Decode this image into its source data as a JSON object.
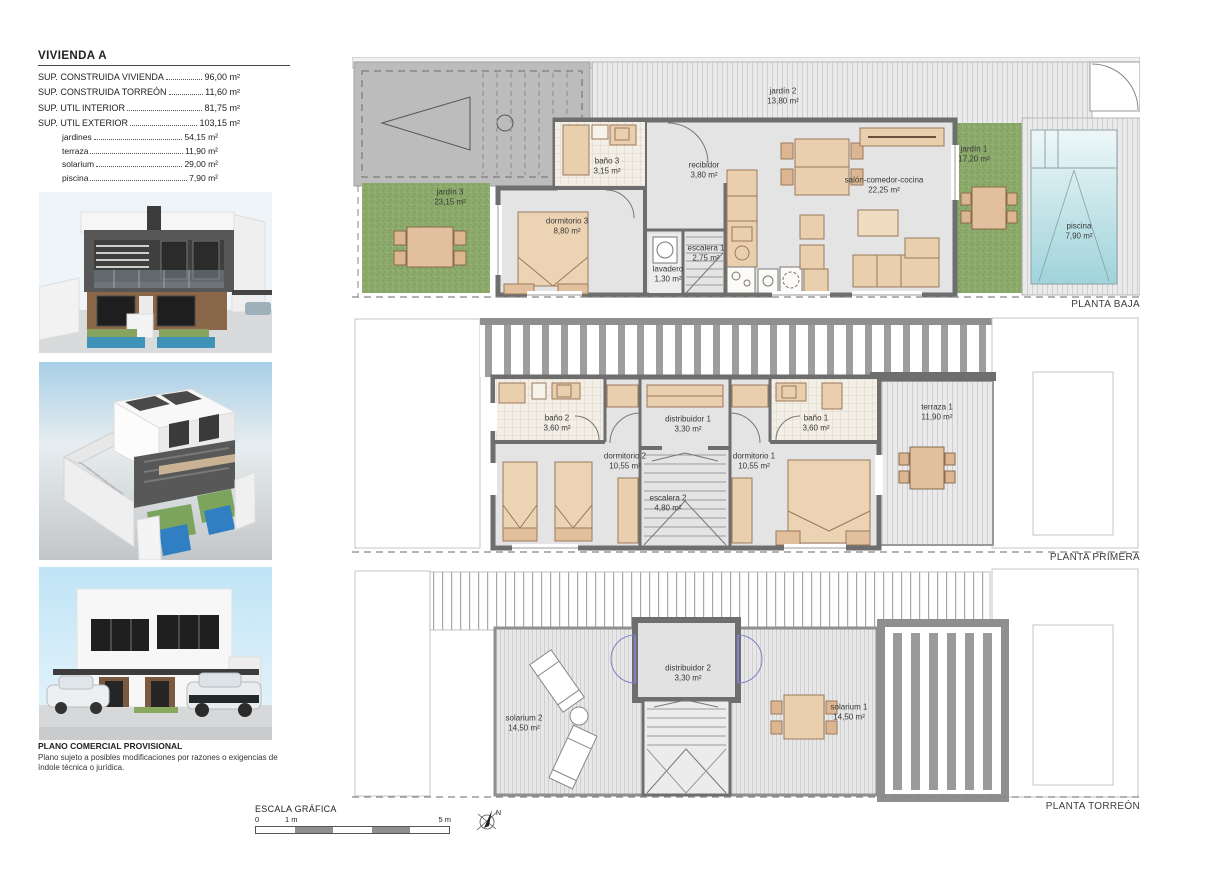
{
  "title_block": {
    "title": "VIVIENDA A",
    "rows": [
      {
        "label": "SUP. CONSTRUIDA VIVIENDA",
        "value": "96,00 m²"
      },
      {
        "label": "SUP. CONSTRUIDA TORREÓN",
        "value": "11,60 m²"
      },
      {
        "label": "SUP. UTIL INTERIOR",
        "value": "81,75 m²"
      },
      {
        "label": "SUP. UTIL EXTERIOR",
        "value": "103,15 m²"
      }
    ],
    "sub_rows": [
      {
        "label": "jardines",
        "value": "54,15 m²"
      },
      {
        "label": "terraza",
        "value": "11,90 m²"
      },
      {
        "label": "solarium",
        "value": "29,00 m²"
      },
      {
        "label": "piscina",
        "value": "7,90 m²"
      }
    ]
  },
  "plans": {
    "baja": {
      "name": "PLANTA BAJA",
      "rooms": {
        "jardin3": {
          "name": "jardín 3",
          "area": "23,15 m²"
        },
        "jardin2": {
          "name": "jardín 2",
          "area": "13,80 m²"
        },
        "jardin1": {
          "name": "jardín 1",
          "area": "17,20 m²"
        },
        "dormitorio3": {
          "name": "dormitorio 3",
          "area": "8,80 m²"
        },
        "bano3": {
          "name": "baño 3",
          "area": "3,15 m²"
        },
        "recibidor": {
          "name": "recibidor",
          "area": "3,80 m²"
        },
        "lavadero": {
          "name": "lavadero",
          "area": "1,30 m²"
        },
        "escalera1": {
          "name": "escalera 1",
          "area": "2,75 m²"
        },
        "salon": {
          "name": "salón-comedor-cocina",
          "area": "22,25 m²"
        },
        "piscina": {
          "name": "piscina",
          "area": "7,90 m²"
        }
      }
    },
    "primera": {
      "name": "PLANTA PRIMERA",
      "rooms": {
        "bano2": {
          "name": "baño 2",
          "area": "3,60 m²"
        },
        "dormitorio2": {
          "name": "dormitorio 2",
          "area": "10,55 m²"
        },
        "distribuidor1": {
          "name": "distribuidor 1",
          "area": "3,30 m²"
        },
        "escalera2": {
          "name": "escalera 2",
          "area": "4,80 m²"
        },
        "dormitorio1": {
          "name": "dormitorio 1",
          "area": "10,55 m²"
        },
        "bano1": {
          "name": "baño 1",
          "area": "3,60 m²"
        },
        "terraza1": {
          "name": "terraza 1",
          "area": "11,90 m²"
        }
      }
    },
    "torreon": {
      "name": "PLANTA TORREÓN",
      "rooms": {
        "solarium2": {
          "name": "solarium 2",
          "area": "14,50 m²"
        },
        "distribuidor2": {
          "name": "distribuidor 2",
          "area": "3,30 m²"
        },
        "solarium1": {
          "name": "solarium 1",
          "area": "14,50 m²"
        }
      }
    }
  },
  "footer": {
    "disclaimer_title": "PLANO COMERCIAL PROVISIONAL",
    "disclaimer_body": "Plano sujeto a posibles modificaciones por razones o exigencias de índole técnica o jurídica."
  },
  "scale_bar": {
    "title": "ESCALA GRÁFICA",
    "tick_zero": "0",
    "tick_one": "1 m",
    "tick_five": "5 m",
    "north": "N"
  },
  "colors": {
    "wall_gray": "#6e6e6e",
    "floor_gray": "#e4e4e4",
    "garden_green": "#8caa6b",
    "furniture_tan": "#e9cfae",
    "pool_blue": "#9fd3da",
    "door_blue": "#8080cc"
  }
}
